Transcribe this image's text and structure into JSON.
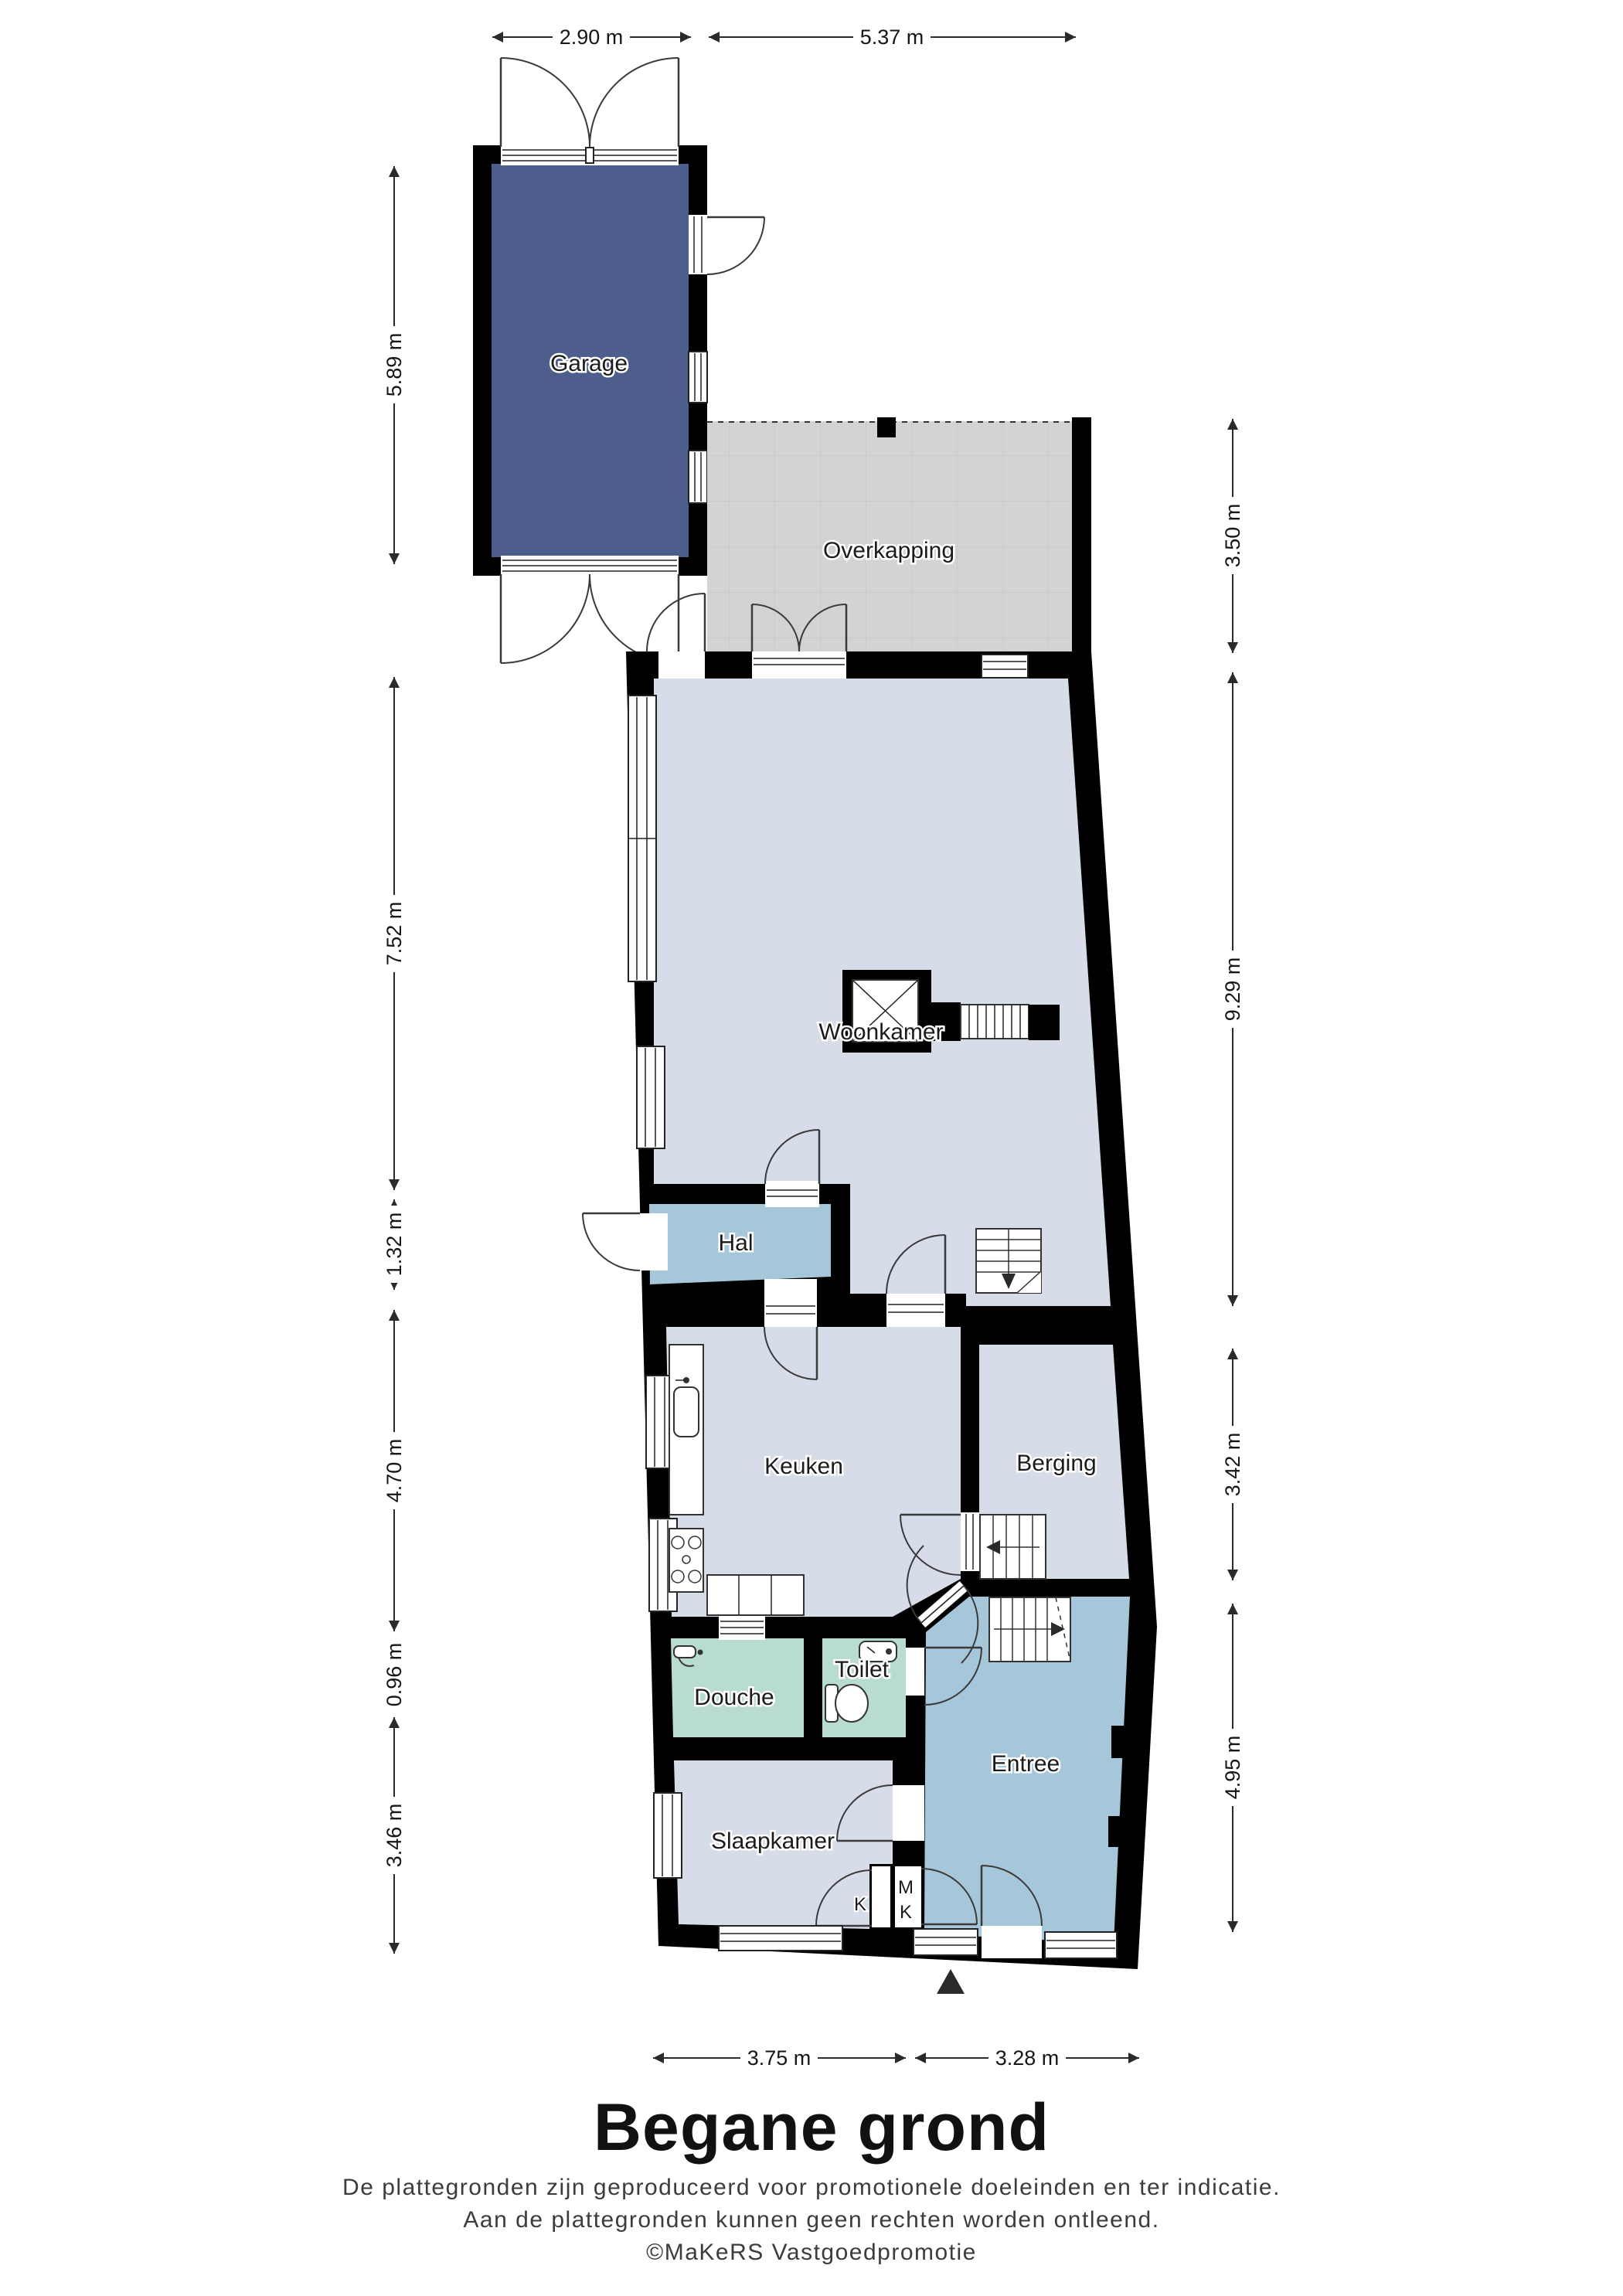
{
  "meta": {
    "floor_title": "Begane grond",
    "disclaimer_line1": "De plattegronden zijn geproduceerd voor promotionele doeleinden en ter indicatie.",
    "disclaimer_line2": "Aan de plattegronden kunnen geen rechten worden ontleend.",
    "credit": "©MaKeRS Vastgoedpromotie"
  },
  "rooms": {
    "garage": {
      "label": "Garage"
    },
    "overkapping": {
      "label": "Overkapping"
    },
    "woonkamer": {
      "label": "Woonkamer"
    },
    "hal": {
      "label": "Hal"
    },
    "keuken": {
      "label": "Keuken"
    },
    "berging": {
      "label": "Berging"
    },
    "douche": {
      "label": "Douche"
    },
    "toilet": {
      "label": "Toilet"
    },
    "slaapkamer": {
      "label": "Slaapkamer"
    },
    "entree": {
      "label": "Entree"
    }
  },
  "closets": {
    "k": "K",
    "mk_m": "M",
    "mk_k": "K"
  },
  "dimensions": {
    "top": [
      {
        "label": "2.90 m"
      },
      {
        "label": "5.37 m"
      }
    ],
    "left": [
      {
        "label": "5.89 m"
      },
      {
        "label": "7.52 m"
      },
      {
        "label": "1.32 m"
      },
      {
        "label": "4.70 m"
      },
      {
        "label": "0.96 m"
      },
      {
        "label": "3.46 m"
      }
    ],
    "right": [
      {
        "label": "3.50 m"
      },
      {
        "label": "9.29 m"
      },
      {
        "label": "3.42 m"
      },
      {
        "label": "4.95 m"
      }
    ],
    "bottom": [
      {
        "label": "3.75 m"
      },
      {
        "label": "3.28 m"
      }
    ]
  },
  "colors": {
    "wall": "#000000",
    "living": "#d6dde9",
    "hall": "#a6c6d9",
    "entree": "#a6c6d9",
    "bath": "#b9dcd2",
    "garage": "#4d5e8c",
    "overkapping": "#d2d3d5",
    "white": "#ffffff"
  }
}
